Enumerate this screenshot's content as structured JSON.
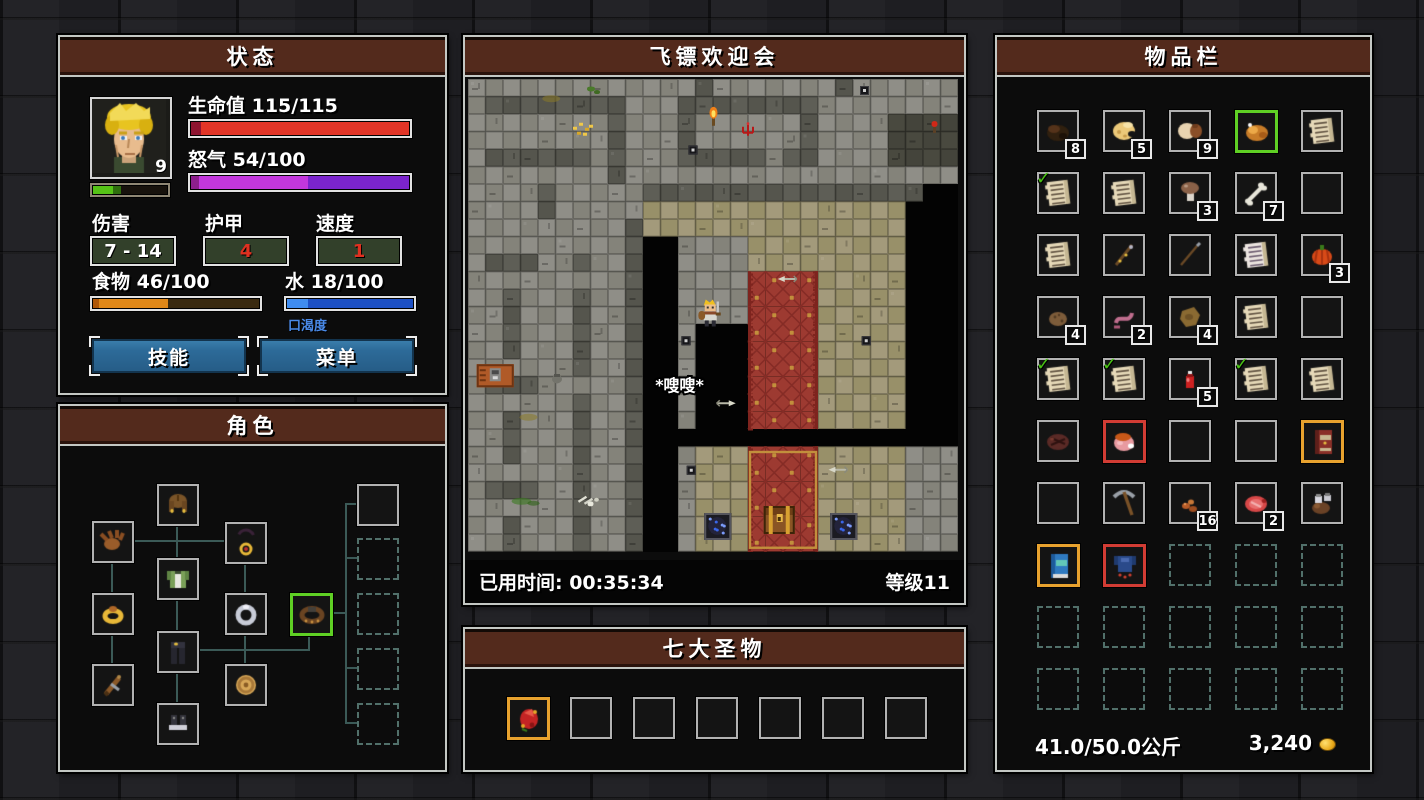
{
  "status_panel": {
    "title": "状态",
    "portrait_level": "9",
    "xp_pct": 40,
    "health_label": "生命值 115/115",
    "health_pct": 100,
    "rage_label": "怒气 54/100",
    "rage_pct": 54,
    "damage_label": "伤害",
    "damage_value": "7 - 14",
    "armor_label": "护甲",
    "armor_value": "4",
    "speed_label": "速度",
    "speed_value": "1",
    "food_label": "食物 46/100",
    "food_pct": 46,
    "water_label": "水 18/100",
    "water_pct": 18,
    "thirst_label": "口渴度",
    "skills_button": "技能",
    "menu_button": "菜单"
  },
  "character_panel": {
    "title": "角色",
    "slots": [
      {
        "id": "helmet",
        "icon": "helm-hair",
        "x": 97,
        "y": 78,
        "border": "normal"
      },
      {
        "id": "gloves",
        "icon": "gloves",
        "x": 32,
        "y": 115,
        "border": "normal"
      },
      {
        "id": "amulet",
        "icon": "amulet",
        "x": 165,
        "y": 116,
        "border": "normal"
      },
      {
        "id": "chest-armor",
        "icon": "tunic",
        "x": 97,
        "y": 152,
        "border": "normal"
      },
      {
        "id": "ring-left",
        "icon": "ring-gold",
        "x": 32,
        "y": 187,
        "border": "normal"
      },
      {
        "id": "ring-right",
        "icon": "ring-silver",
        "x": 165,
        "y": 187,
        "border": "normal"
      },
      {
        "id": "belt",
        "icon": "belt",
        "x": 230,
        "y": 187,
        "border": "sel"
      },
      {
        "id": "pants",
        "icon": "pants",
        "x": 97,
        "y": 225,
        "border": "normal"
      },
      {
        "id": "weapon",
        "icon": "sword-wood",
        "x": 32,
        "y": 258,
        "border": "normal"
      },
      {
        "id": "shield",
        "icon": "shield-round",
        "x": 165,
        "y": 258,
        "border": "normal"
      },
      {
        "id": "boots",
        "icon": "boots",
        "x": 97,
        "y": 297,
        "border": "normal"
      },
      {
        "id": "extra-1",
        "icon": null,
        "x": 297,
        "y": 78,
        "border": "normal"
      },
      {
        "id": "extra-2",
        "icon": null,
        "x": 297,
        "y": 132,
        "border": "dash"
      },
      {
        "id": "extra-3",
        "icon": null,
        "x": 297,
        "y": 187,
        "border": "dash"
      },
      {
        "id": "extra-4",
        "icon": null,
        "x": 297,
        "y": 242,
        "border": "dash"
      },
      {
        "id": "extra-5",
        "icon": null,
        "x": 297,
        "y": 297,
        "border": "dash"
      }
    ],
    "lines": [
      {
        "x": 116,
        "y": 118,
        "w": 2,
        "h": 34
      },
      {
        "x": 116,
        "y": 192,
        "w": 2,
        "h": 33
      },
      {
        "x": 116,
        "y": 265,
        "w": 2,
        "h": 32
      },
      {
        "x": 72,
        "y": 134,
        "w": 93,
        "h": 2
      },
      {
        "x": 51,
        "y": 155,
        "w": 2,
        "h": 32
      },
      {
        "x": 51,
        "y": 227,
        "w": 2,
        "h": 31
      },
      {
        "x": 184,
        "y": 156,
        "w": 2,
        "h": 31
      },
      {
        "x": 184,
        "y": 227,
        "w": 2,
        "h": 31
      },
      {
        "x": 137,
        "y": 243,
        "w": 113,
        "h": 2
      },
      {
        "x": 248,
        "y": 227,
        "w": 2,
        "h": 18
      },
      {
        "x": 270,
        "y": 206,
        "w": 16,
        "h": 2
      },
      {
        "x": 285,
        "y": 97,
        "w": 2,
        "h": 220
      },
      {
        "x": 285,
        "y": 97,
        "w": 12,
        "h": 2
      },
      {
        "x": 285,
        "y": 151,
        "w": 12,
        "h": 2
      },
      {
        "x": 285,
        "y": 261,
        "w": 12,
        "h": 2
      },
      {
        "x": 285,
        "y": 316,
        "w": 12,
        "h": 2
      }
    ]
  },
  "map_panel": {
    "title": "飞镖欢迎会",
    "elapsed_label": "已用时间: 00:35:34",
    "level_label": "等级11",
    "sfx_text": "*嗖嗖*",
    "palette": {
      "g": [
        "#8f8e87",
        "#84837a"
      ],
      "G": [
        "#5e5e56",
        "#55554d"
      ],
      "b": [
        "#a39a7b",
        "#989069"
      ],
      "f": [
        "#49493f",
        "#44443b"
      ],
      "carpet": "#9d3a31",
      "carpet_dark": "#852c26",
      "carpet_gold": "#c28f3c",
      "void": "#030303"
    },
    "tiles": [
      "gggggggggggggGgggggggGgggggg",
      "gGGGGGGGGgggGGGGGGGGgggggggg",
      "ggggggggGgggGggggggGggggffff",
      "ggggggggGgggGggggggGggggffff",
      "gGGGGGGgGgggGGGGGgGGggggffff",
      "ggggggggGggggggggggggggggggg",
      "ggggGgggggGGGGGGGGGGGGGGGG..",
      "ggggGgggggbbbbbbbbbbbbbbb...",
      "gggggggggGbbbbbbbbbbbbbbb...",
      "gggggggggG..ggggbbbbbbbbb...",
      "gGGGggGggG..ggggbbbbbbbbb...",
      "gggggggggG..ggggccccbbbbb...",
      "ggGgggGggG..ggggccccbbbbb...",
      "ggGgggGggG..ggggccccbbbbb...",
      "ggGgggGggG..g...ccccbbbbb...",
      "ggGgggGggG..g...ccccbbbbb...",
      "ggggggGggG..g...ccccbbbbb...",
      "gGGGgggggG..g...ccccbbbbb...",
      "ggggggGggG..g...ccccbbbbb...",
      "ggGgggGggG..g...ccccbbbbb...",
      "ggGgggGggG..................",
      "ggGgggGggG..gbbbccccbbbbbggg",
      "ggggggGggG..gbbbccccbbbbbggg",
      "gGGGggGggG..gbbbccccbbbbbggg",
      "ggggggGggG..gbbbccccbbbbbggg",
      "ggGgggGggG..gbbbccccbbbbbggg",
      "ggGgggGggG..gbbbccccbbbbbggg"
    ],
    "objects": [
      {
        "t": "moss",
        "x": 6.8,
        "y": 0.4
      },
      {
        "t": "stain",
        "x": 4.3,
        "y": 0.9
      },
      {
        "t": "debris-gold",
        "x": 6.0,
        "y": 2.5
      },
      {
        "t": "torch",
        "x": 13.6,
        "y": 1.7
      },
      {
        "t": "rune-red",
        "x": 15.6,
        "y": 2.5
      },
      {
        "t": "sconce-red",
        "x": 26.4,
        "y": 2.4
      },
      {
        "t": "darthole",
        "x": 22.4,
        "y": 0.4
      },
      {
        "t": "darthole",
        "x": 12.6,
        "y": 3.8
      },
      {
        "t": "darthole",
        "x": 12.2,
        "y": 14.7
      },
      {
        "t": "darthole",
        "x": 22.5,
        "y": 14.7
      },
      {
        "t": "darthole",
        "x": 12.5,
        "y": 22.1
      },
      {
        "t": "machine",
        "x": 0.5,
        "y": 16.3
      },
      {
        "t": "pot",
        "x": 4.8,
        "y": 16.8
      },
      {
        "t": "stain",
        "x": 3.0,
        "y": 19.1
      },
      {
        "t": "slime",
        "x": 2.6,
        "y": 23.9
      },
      {
        "t": "bones",
        "x": 6.2,
        "y": 23.7
      },
      {
        "t": "carpet-outline",
        "x": 16,
        "y": 21.2,
        "w": 4,
        "h": 5.7
      },
      {
        "t": "chest",
        "x": 16.9,
        "y": 24.4
      },
      {
        "t": "rune-circle",
        "x": 13.5,
        "y": 24.8
      },
      {
        "t": "rune-circle",
        "x": 20.7,
        "y": 24.8
      },
      {
        "t": "arrow-left",
        "x": 17.7,
        "y": 11.2
      },
      {
        "t": "arrow-right",
        "x": 14.1,
        "y": 18.3
      },
      {
        "t": "arrow-left",
        "x": 20.6,
        "y": 22.1
      },
      {
        "t": "player",
        "x": 13.3,
        "y": 12.6
      },
      {
        "t": "sfx",
        "x": 10.7,
        "y": 17.5
      }
    ]
  },
  "relics_panel": {
    "title": "七大圣物",
    "slots": [
      {
        "icon": "relic-red",
        "border": "gold"
      },
      {
        "icon": null,
        "border": "normal"
      },
      {
        "icon": null,
        "border": "normal"
      },
      {
        "icon": null,
        "border": "normal"
      },
      {
        "icon": null,
        "border": "normal"
      },
      {
        "icon": null,
        "border": "normal"
      },
      {
        "icon": null,
        "border": "normal"
      }
    ]
  },
  "inventory_panel": {
    "title": "物品栏",
    "weight": "41.0/50.0公斤",
    "money": "3,240",
    "slots": [
      {
        "icon": "dried-meat",
        "count": "8"
      },
      {
        "icon": "cheese",
        "count": "5"
      },
      {
        "icon": "bread",
        "count": "9"
      },
      {
        "icon": "roast",
        "border": "sel"
      },
      {
        "icon": "scroll"
      },
      {
        "icon": "scroll",
        "checked": true
      },
      {
        "icon": "scroll"
      },
      {
        "icon": "mushroom",
        "count": "3"
      },
      {
        "icon": "bone",
        "count": "7"
      },
      {
        "icon": null
      },
      {
        "icon": "scroll"
      },
      {
        "icon": "wand"
      },
      {
        "icon": "spear"
      },
      {
        "icon": "scroll-pale"
      },
      {
        "icon": "pumpkin",
        "count": "3"
      },
      {
        "icon": "potato",
        "count": "4"
      },
      {
        "icon": "worm",
        "count": "2"
      },
      {
        "icon": "hide",
        "count": "4"
      },
      {
        "icon": "scroll"
      },
      {
        "icon": null
      },
      {
        "icon": "scroll",
        "checked": true
      },
      {
        "icon": "scroll",
        "checked": true
      },
      {
        "icon": "potion-red",
        "count": "5"
      },
      {
        "icon": "scroll",
        "checked": true
      },
      {
        "icon": "scroll"
      },
      {
        "icon": "steak-dark"
      },
      {
        "icon": "ham",
        "border": "red"
      },
      {
        "icon": null
      },
      {
        "icon": null
      },
      {
        "icon": "tome-red",
        "border": "gold"
      },
      {
        "icon": null
      },
      {
        "icon": "pickaxe"
      },
      {
        "icon": "ore",
        "count": "16"
      },
      {
        "icon": "steak-raw",
        "count": "2"
      },
      {
        "icon": "jars"
      },
      {
        "icon": "tome-blue",
        "border": "gold"
      },
      {
        "icon": "armor-blue",
        "border": "red"
      },
      {
        "icon": null,
        "border": "dash"
      },
      {
        "icon": null,
        "border": "dash"
      },
      {
        "icon": null,
        "border": "dash"
      },
      {
        "icon": null,
        "border": "dash"
      },
      {
        "icon": null,
        "border": "dash"
      },
      {
        "icon": null,
        "border": "dash"
      },
      {
        "icon": null,
        "border": "dash"
      },
      {
        "icon": null,
        "border": "dash"
      },
      {
        "icon": null,
        "border": "dash"
      },
      {
        "icon": null,
        "border": "dash"
      },
      {
        "icon": null,
        "border": "dash"
      },
      {
        "icon": null,
        "border": "dash"
      },
      {
        "icon": null,
        "border": "dash"
      }
    ]
  }
}
